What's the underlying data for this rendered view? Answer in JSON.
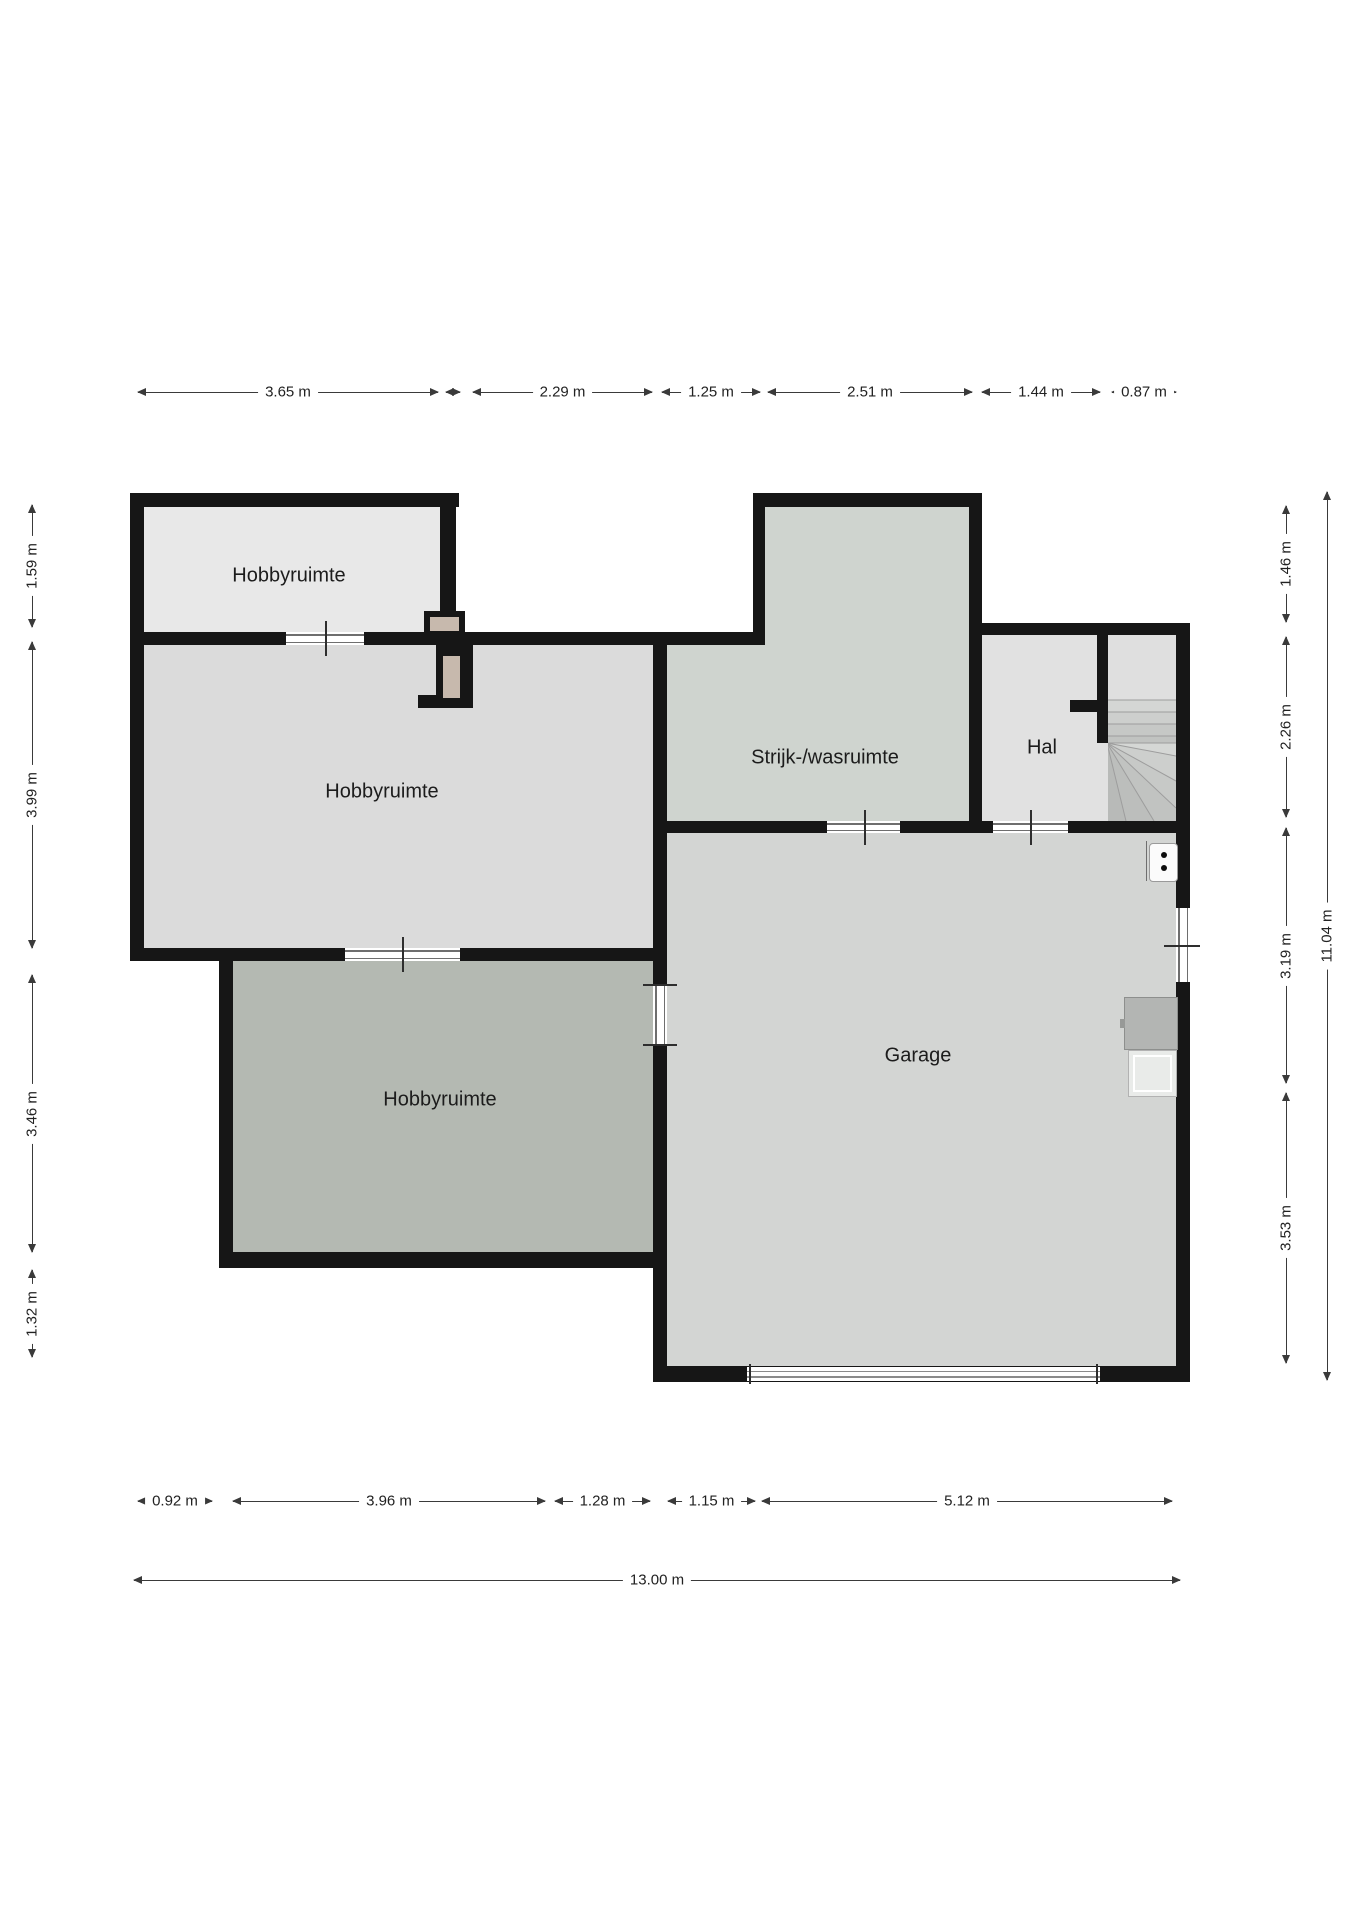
{
  "unit": "m",
  "colors": {
    "wall": "#161616",
    "floor_hobby1": "#e8e8e8",
    "floor_hobby2": "#dbdbdb",
    "floor_hobby3": "#b4b9b2",
    "floor_strijk": "#cfd4cf",
    "floor_hal": "#e1e1e1",
    "floor_garage": "#d3d5d3",
    "chimney_fill": "#c7b9ad",
    "dim_line": "#3a3a3a"
  },
  "rooms": [
    {
      "id": "hobbyruimte-1",
      "label": "Hobbyruimte",
      "cx": 289,
      "cy": 576
    },
    {
      "id": "hobbyruimte-2",
      "label": "Hobbyruimte",
      "cx": 382,
      "cy": 792
    },
    {
      "id": "hobbyruimte-3",
      "label": "Hobbyruimte",
      "cx": 440,
      "cy": 1100
    },
    {
      "id": "strijk-wasruimte",
      "label": "Strijk-/wasruimte",
      "cx": 825,
      "cy": 758
    },
    {
      "id": "hal",
      "label": "Hal",
      "cx": 1042,
      "cy": 748
    },
    {
      "id": "garage",
      "label": "Garage",
      "cx": 918,
      "cy": 1056
    }
  ],
  "dimensions": {
    "top": {
      "orient": "h",
      "pos": 392,
      "segments": [
        {
          "label": "3.65 m",
          "from": 138,
          "to": 438
        },
        {
          "label": "",
          "from": 446,
          "to": 460
        },
        {
          "label": "2.29 m",
          "from": 473,
          "to": 652
        },
        {
          "label": "1.25 m",
          "from": 662,
          "to": 760
        },
        {
          "label": "2.51 m",
          "from": 768,
          "to": 972
        },
        {
          "label": "1.44 m",
          "from": 982,
          "to": 1100
        },
        {
          "label": "0.87 m",
          "from": 1112,
          "to": 1176
        }
      ]
    },
    "left": {
      "orient": "v",
      "pos": 32,
      "segments": [
        {
          "label": "1.59 m",
          "from": 505,
          "to": 627
        },
        {
          "label": "3.99 m",
          "from": 642,
          "to": 948
        },
        {
          "label": "3.46 m",
          "from": 975,
          "to": 1252
        },
        {
          "label": "1.32 m",
          "from": 1270,
          "to": 1357
        }
      ]
    },
    "right_inner": {
      "orient": "v",
      "pos": 1286,
      "segments": [
        {
          "label": "1.46 m",
          "from": 506,
          "to": 622
        },
        {
          "label": "2.26 m",
          "from": 637,
          "to": 817
        },
        {
          "label": "3.19 m",
          "from": 828,
          "to": 1083
        },
        {
          "label": "3.53 m",
          "from": 1093,
          "to": 1363
        }
      ]
    },
    "right_outer": {
      "orient": "v",
      "pos": 1327,
      "segments": [
        {
          "label": "11.04 m",
          "from": 492,
          "to": 1380
        }
      ]
    },
    "bottom_segments": {
      "orient": "h",
      "pos": 1501,
      "segments": [
        {
          "label": "0.92 m",
          "from": 138,
          "to": 212
        },
        {
          "label": "3.96 m",
          "from": 233,
          "to": 545
        },
        {
          "label": "1.28 m",
          "from": 555,
          "to": 650
        },
        {
          "label": "1.15 m",
          "from": 668,
          "to": 755
        },
        {
          "label": "5.12 m",
          "from": 762,
          "to": 1172
        }
      ]
    },
    "bottom_total": {
      "orient": "h",
      "pos": 1580,
      "segments": [
        {
          "label": "13.00 m",
          "from": 134,
          "to": 1180
        }
      ]
    }
  }
}
